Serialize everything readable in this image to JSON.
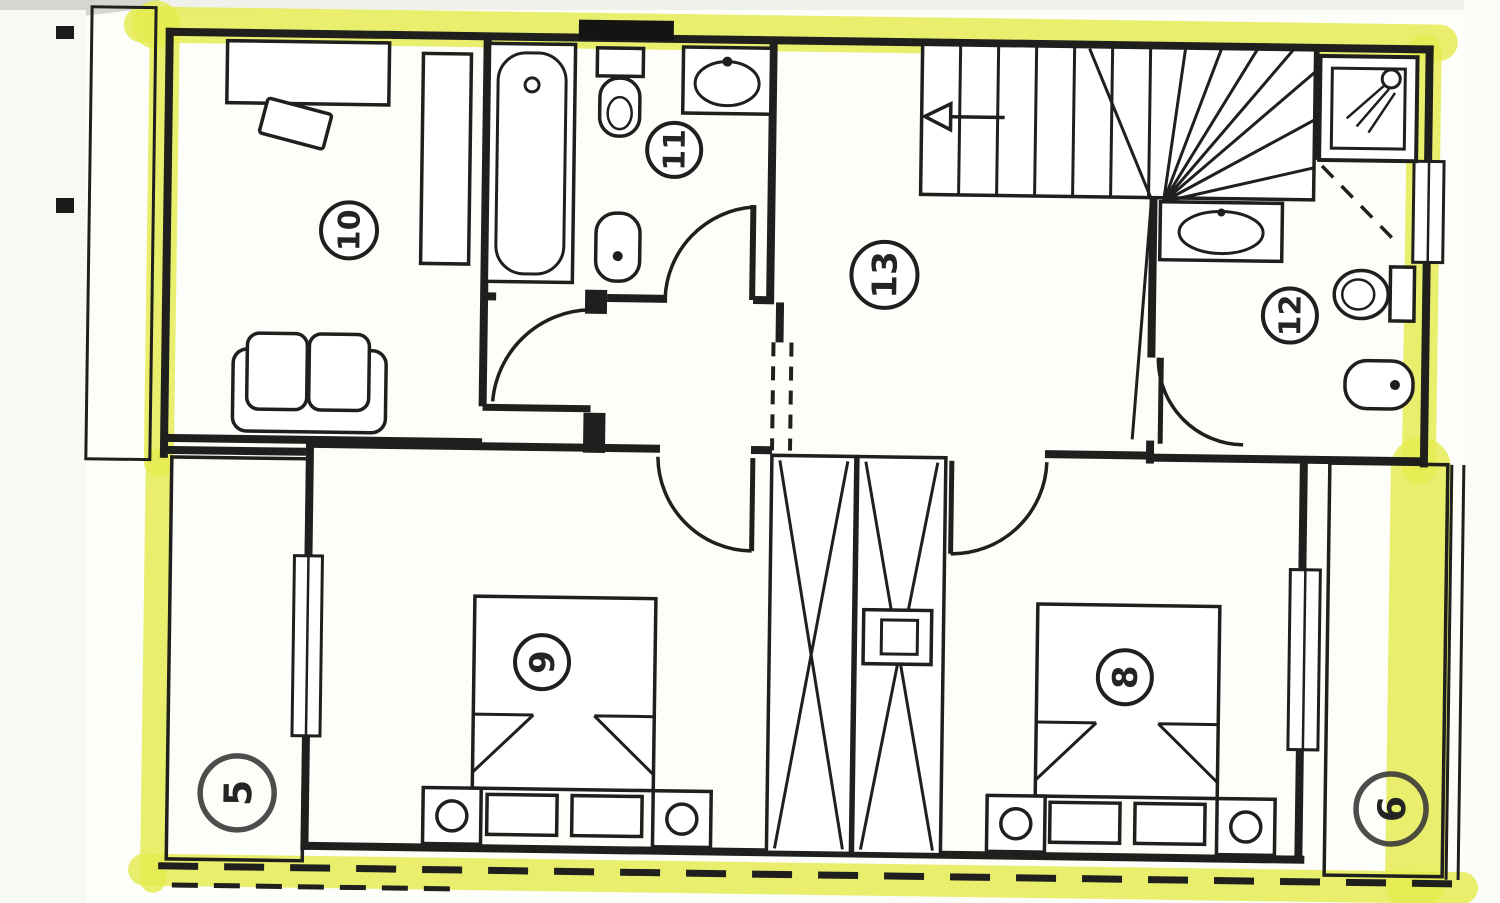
{
  "plan": {
    "rooms": [
      {
        "id": "study-top-left",
        "number": "10"
      },
      {
        "id": "bathroom-top",
        "number": "11"
      },
      {
        "id": "hall-landing",
        "number": "13"
      },
      {
        "id": "bathroom-right",
        "number": "12"
      },
      {
        "id": "bedroom-left",
        "number": "9"
      },
      {
        "id": "bedroom-right",
        "number": "8"
      },
      {
        "id": "terrace-left",
        "number": "5"
      },
      {
        "id": "terrace-right",
        "number": "6"
      }
    ],
    "colors": {
      "highlighter": "#e4eb4e",
      "ink": "#1f1f1e",
      "paper": "#fdfdfa",
      "brick_ink": "#2b2b2a"
    },
    "fixtures": [
      "desk",
      "chair",
      "wardrobe",
      "sofa",
      "bathtub",
      "toilet",
      "washbasin",
      "bidet",
      "staircase",
      "stair-direction-arrow",
      "shower-cabin",
      "double-bed",
      "pillow",
      "nightstand",
      "bedside-lamp",
      "closet",
      "duct-shaft",
      "window",
      "door-swing",
      "terrace-paving",
      "dashed-boundary"
    ]
  }
}
